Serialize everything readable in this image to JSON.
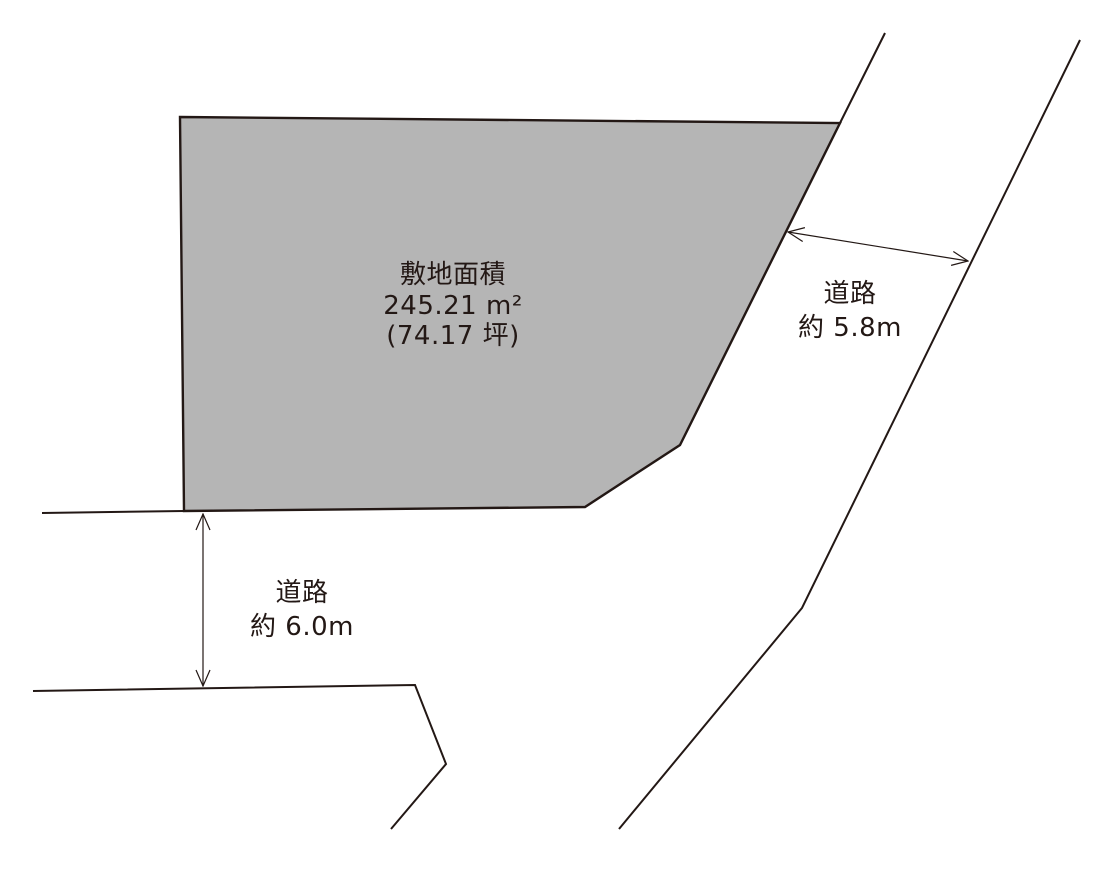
{
  "diagram_type": "land-plot-site-plan",
  "colors": {
    "plot_fill": "#b5b5b5",
    "line": "#231815",
    "background": "#ffffff"
  },
  "plot": {
    "area_title": "敷地面積",
    "area_value": "245.21 m²",
    "area_tsubo": "(74.17 坪)"
  },
  "roads": {
    "east": {
      "label": "道路",
      "width": "約 5.8m"
    },
    "south": {
      "label": "道路",
      "width": "約 6.0m"
    }
  }
}
